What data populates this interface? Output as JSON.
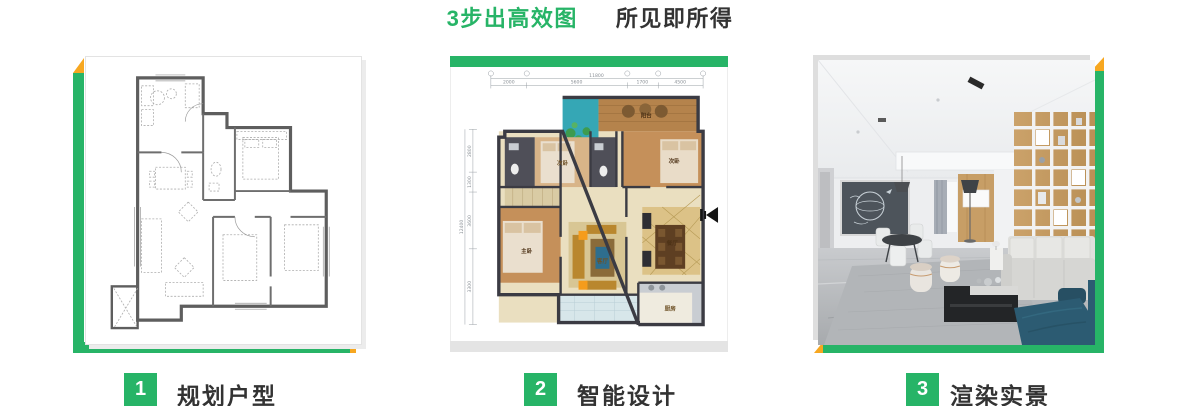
{
  "title": {
    "highlight": "3步出高效图",
    "tagline": "所见即所得"
  },
  "colors": {
    "green": "#27B467",
    "orange": "#F7A720",
    "text_dark": "#333333"
  },
  "steps": [
    {
      "number": "1",
      "label": "规划户型"
    },
    {
      "number": "2",
      "label": "智能设计"
    },
    {
      "number": "3",
      "label": "渲染实景"
    }
  ],
  "floorplan": {
    "total_width": "11800",
    "total_height": "12400",
    "dims_top": [
      "2000",
      "5600",
      "1700",
      "4500"
    ],
    "dims_left": [
      "2800",
      "1300",
      "3600",
      "3300"
    ],
    "rooms": {
      "balcony": "阳台",
      "bedroom2a": "次卧",
      "bedroom2b": "次卧",
      "master": "主卧",
      "living": "客厅",
      "dining": "餐厅",
      "kitchen": "厨房"
    }
  }
}
